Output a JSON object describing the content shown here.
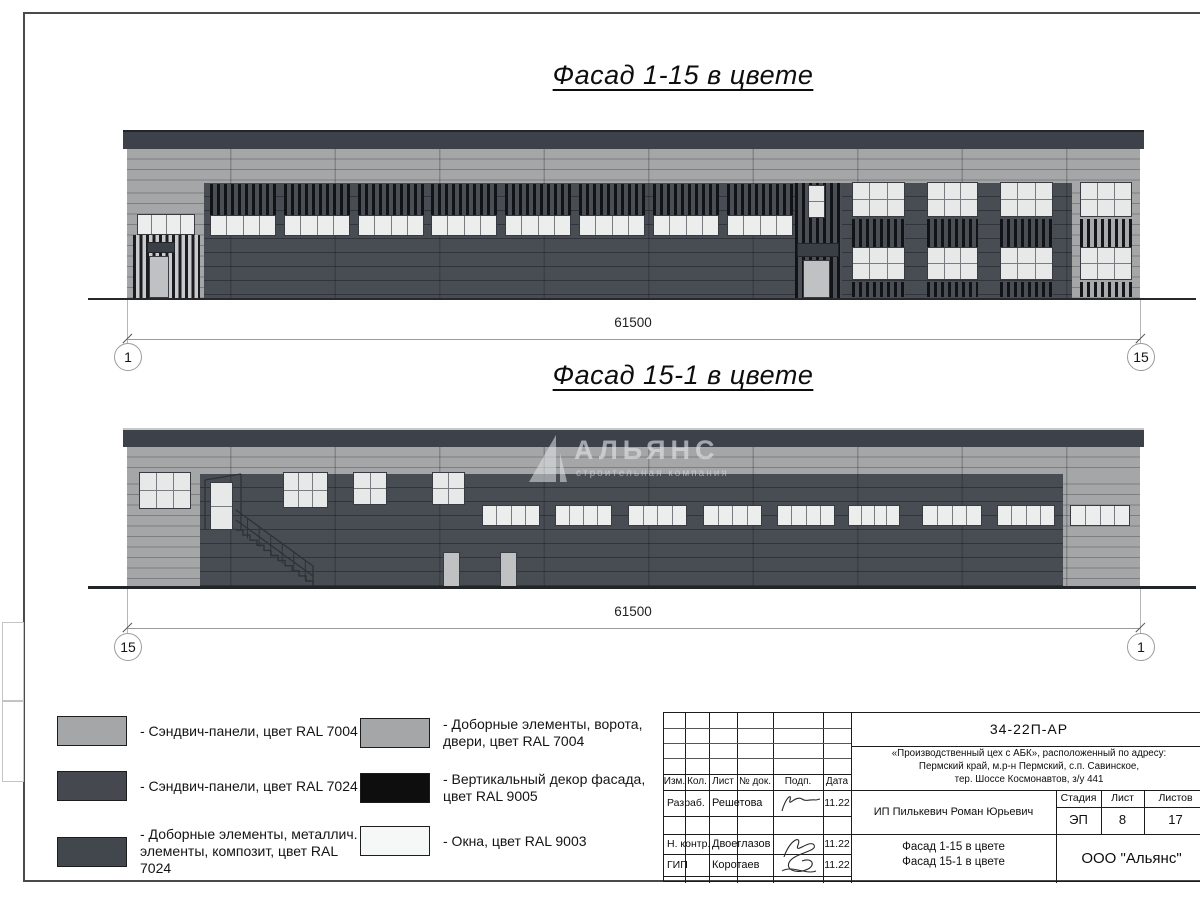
{
  "titles": {
    "facade1": "Фасад 1-15 в цвете",
    "facade2": "Фасад 15-1 в цвете"
  },
  "dimensions": {
    "facade1": {
      "length": "61500",
      "axis_left": "1",
      "axis_right": "15"
    },
    "facade2": {
      "length": "61500",
      "axis_left": "15",
      "axis_right": "1"
    }
  },
  "watermark": {
    "name": "АЛЬЯНС",
    "subtitle": "строительная компания"
  },
  "colors": {
    "panel_light_ral7004": "#a4a6a7",
    "panel_dark_ral7024": "#45494f",
    "composite_ral7024": "#42464d",
    "decor_black_ral9005": "#0e0e0f",
    "window_white_ral9003": "#f6f7f7"
  },
  "legend": {
    "items": [
      {
        "swatch": "#a4a6a7",
        "label": "- Сэндвич-панели, цвет RAL 7004"
      },
      {
        "swatch": "#45494f",
        "label": "- Сэндвич-панели, цвет RAL 7024"
      },
      {
        "swatch": "#42464d",
        "label": "- Доборные элементы, металлич. элементы, композит, цвет RAL 7024"
      },
      {
        "swatch": "#a4a6a7",
        "label": "- Доборные элементы, ворота, двери, цвет RAL 7004"
      },
      {
        "swatch": "#0e0e0f",
        "label": "- Вертикальный декор фасада, цвет RAL 9005"
      },
      {
        "swatch": "#f6f7f7",
        "label": "- Окна, цвет RAL 9003"
      }
    ]
  },
  "title_block": {
    "doc_code": "34-22П-АР",
    "project_line1": "«Производственный цех с АБК», расположенный по адресу:",
    "project_line2": "Пермский край, м.р-н Пермский, с.п. Савинское,",
    "project_line3": "тер. Шоссе Космонавтов, з/у 441",
    "columns": [
      "Изм.",
      "Кол.",
      "Лист",
      "№ док.",
      "Подп.",
      "Дата"
    ],
    "rows": [
      {
        "role": "Разраб.",
        "name": "Решетова",
        "date": "11.22"
      },
      {
        "role": "Н. контр.",
        "name": "Двоеглазов",
        "date": "11.22"
      },
      {
        "role": "ГИП",
        "name": "Коротаев",
        "date": "11.22"
      }
    ],
    "client": "ИП Пилькевич Роман Юрьевич",
    "stage_label": "Стадия",
    "sheet_label": "Лист",
    "sheets_label": "Листов",
    "stage": "ЭП",
    "sheet": "8",
    "sheets": "17",
    "sheet_title_line1": "Фасад 1-15 в цвете",
    "sheet_title_line2": "Фасад 15-1 в цвете",
    "company": "ООО \"Альянс\""
  }
}
